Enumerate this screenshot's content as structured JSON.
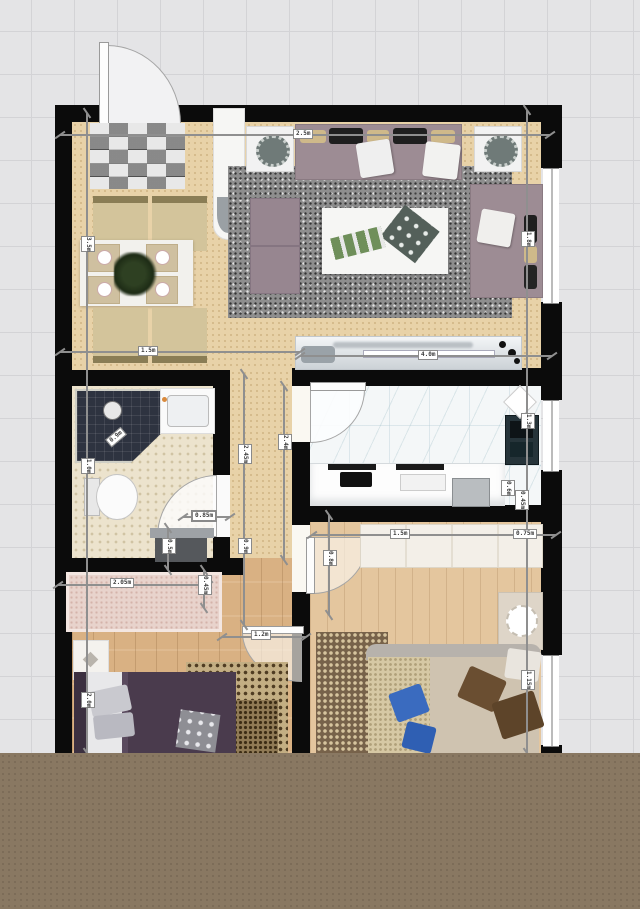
{
  "dims": {
    "top": "2.5m",
    "dining": "1.5m",
    "counter": "4.0m",
    "left_upper": "3.5m",
    "left_mid": "1.0m",
    "left_lower": "2.0m",
    "hall_a": "2.45m",
    "hall_b": "0.9m",
    "hall_c": "2.4m",
    "right_upper": "1.8m",
    "right_mid": "1.3m",
    "right_lower": "1.15m",
    "bed2_top_a": "1.5m",
    "bed2_top_b": "0.75m",
    "bed2_door": "0.8m",
    "wardrobe_width": "2.05m",
    "wardrobe_depth": "0.45m",
    "bed1_door": "1.2m",
    "bath_door": "0.85m",
    "desk_depth": "0.5m",
    "shower": "0.9m",
    "kitchen_cab_a": "0.6m",
    "kitchen_cab_b": "0.45m"
  },
  "colors": {
    "wall": "#0b0b0b",
    "canvas": "#e4e4e6",
    "gridline": "#d3d3d6",
    "band": "#897862",
    "sand": "#e8d2a8",
    "oak1": "#d9b183",
    "oak2": "#e4c69e",
    "mosaic": "#ece3cd",
    "marble": "#f4f7f8",
    "rug": "#8e8e8e",
    "mauve": "#9d8c94",
    "purple": "#4a3b4d",
    "tan": "#cfc3b0",
    "pink": "#e8d3cc"
  }
}
